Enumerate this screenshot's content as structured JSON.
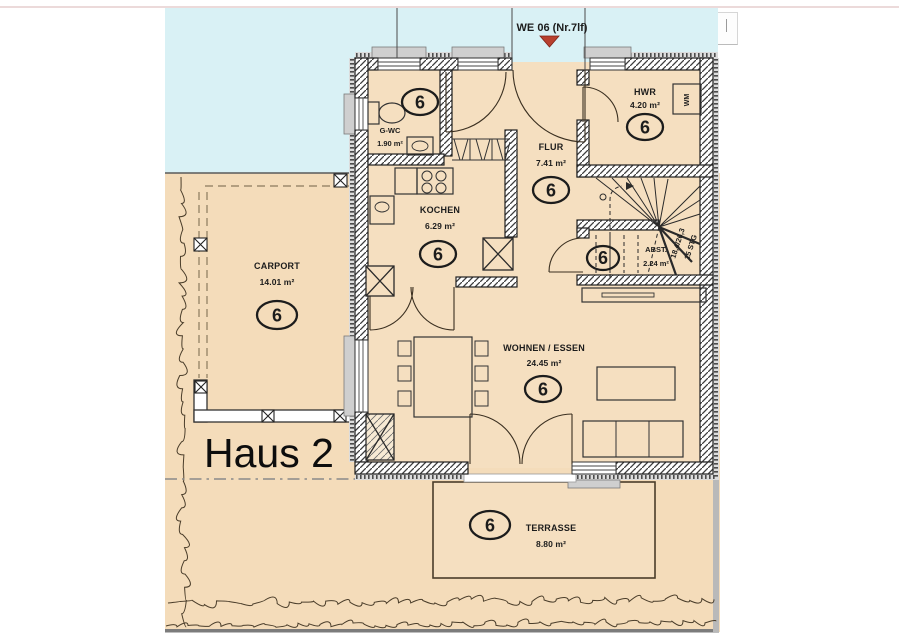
{
  "header": {
    "unit_label": "WE 06 (Nr.7lf)"
  },
  "plan": {
    "house_label": "Haus 2",
    "marker": "6",
    "rooms": [
      {
        "id": "gwc",
        "name": "G-WC",
        "area": "1.90 m²"
      },
      {
        "id": "hwr",
        "name": "HWR",
        "area": "4.20 m²"
      },
      {
        "id": "flur",
        "name": "FLUR",
        "area": "7.41 m²"
      },
      {
        "id": "kochen",
        "name": "KOCHEN",
        "area": "6.29 m²"
      },
      {
        "id": "abst",
        "name": "ABST.",
        "area": "2.24 m²"
      },
      {
        "id": "wohnen",
        "name": "WOHNEN / ESSEN",
        "area": "24.45 m²"
      },
      {
        "id": "carport",
        "name": "CARPORT",
        "area": "14.01 m²"
      },
      {
        "id": "terrasse",
        "name": "TERRASSE",
        "area": "8.80 m²"
      }
    ],
    "stair": {
      "line1": "18,4/26,3",
      "line2": "15 STG"
    },
    "wm_label": "WM"
  },
  "colors": {
    "sky": "#d9f1f5",
    "ground": "#f4dcba",
    "wall_line": "#1f1f1f",
    "marker_red": "#b8402e",
    "insulation": "#dcdcdc"
  }
}
